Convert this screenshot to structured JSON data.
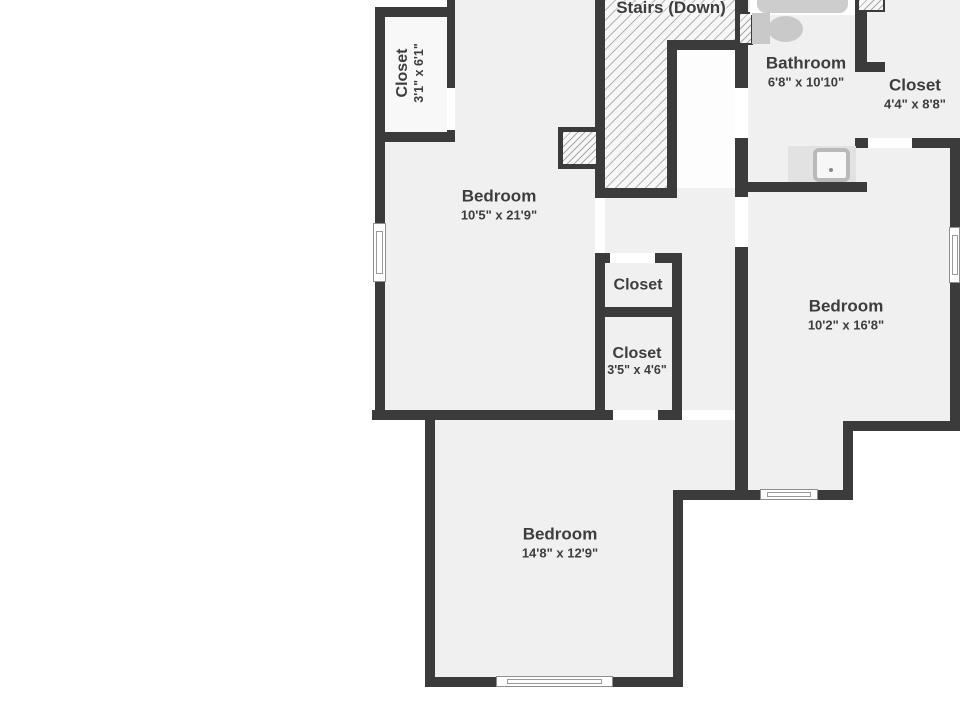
{
  "colors": {
    "wall": "#3b3b3b",
    "floor": "#f0f0f0",
    "closet_floor": "#f8f8f8",
    "stair_landing": "#fdfdfd",
    "outside": "#ffffff",
    "hatch_line": "#b3b3b3",
    "fixture_gray": "#c9c9c9",
    "vanity_gray": "#e2e2e2",
    "text": "#3d3d3d"
  },
  "rooms": {
    "stairs": {
      "label": "Stairs (Down)"
    },
    "closet_top_left": {
      "label": "Closet",
      "dims": "3'1\" x 6'1\""
    },
    "bedroom_left": {
      "label": "Bedroom",
      "dims": "10'5\" x 21'9\""
    },
    "bathroom": {
      "label": "Bathroom",
      "dims": "6'8\" x 10'10\""
    },
    "closet_top_right": {
      "label": "Closet",
      "dims": "4'4\" x 8'8\""
    },
    "closet_middle": {
      "label": "Closet"
    },
    "closet_lower": {
      "label": "Closet",
      "dims": "3'5\" x 4'6\""
    },
    "bedroom_right": {
      "label": "Bedroom",
      "dims": "10'2\" x 16'8\""
    },
    "bedroom_bottom": {
      "label": "Bedroom",
      "dims": "14'8\" x 12'9\""
    }
  }
}
